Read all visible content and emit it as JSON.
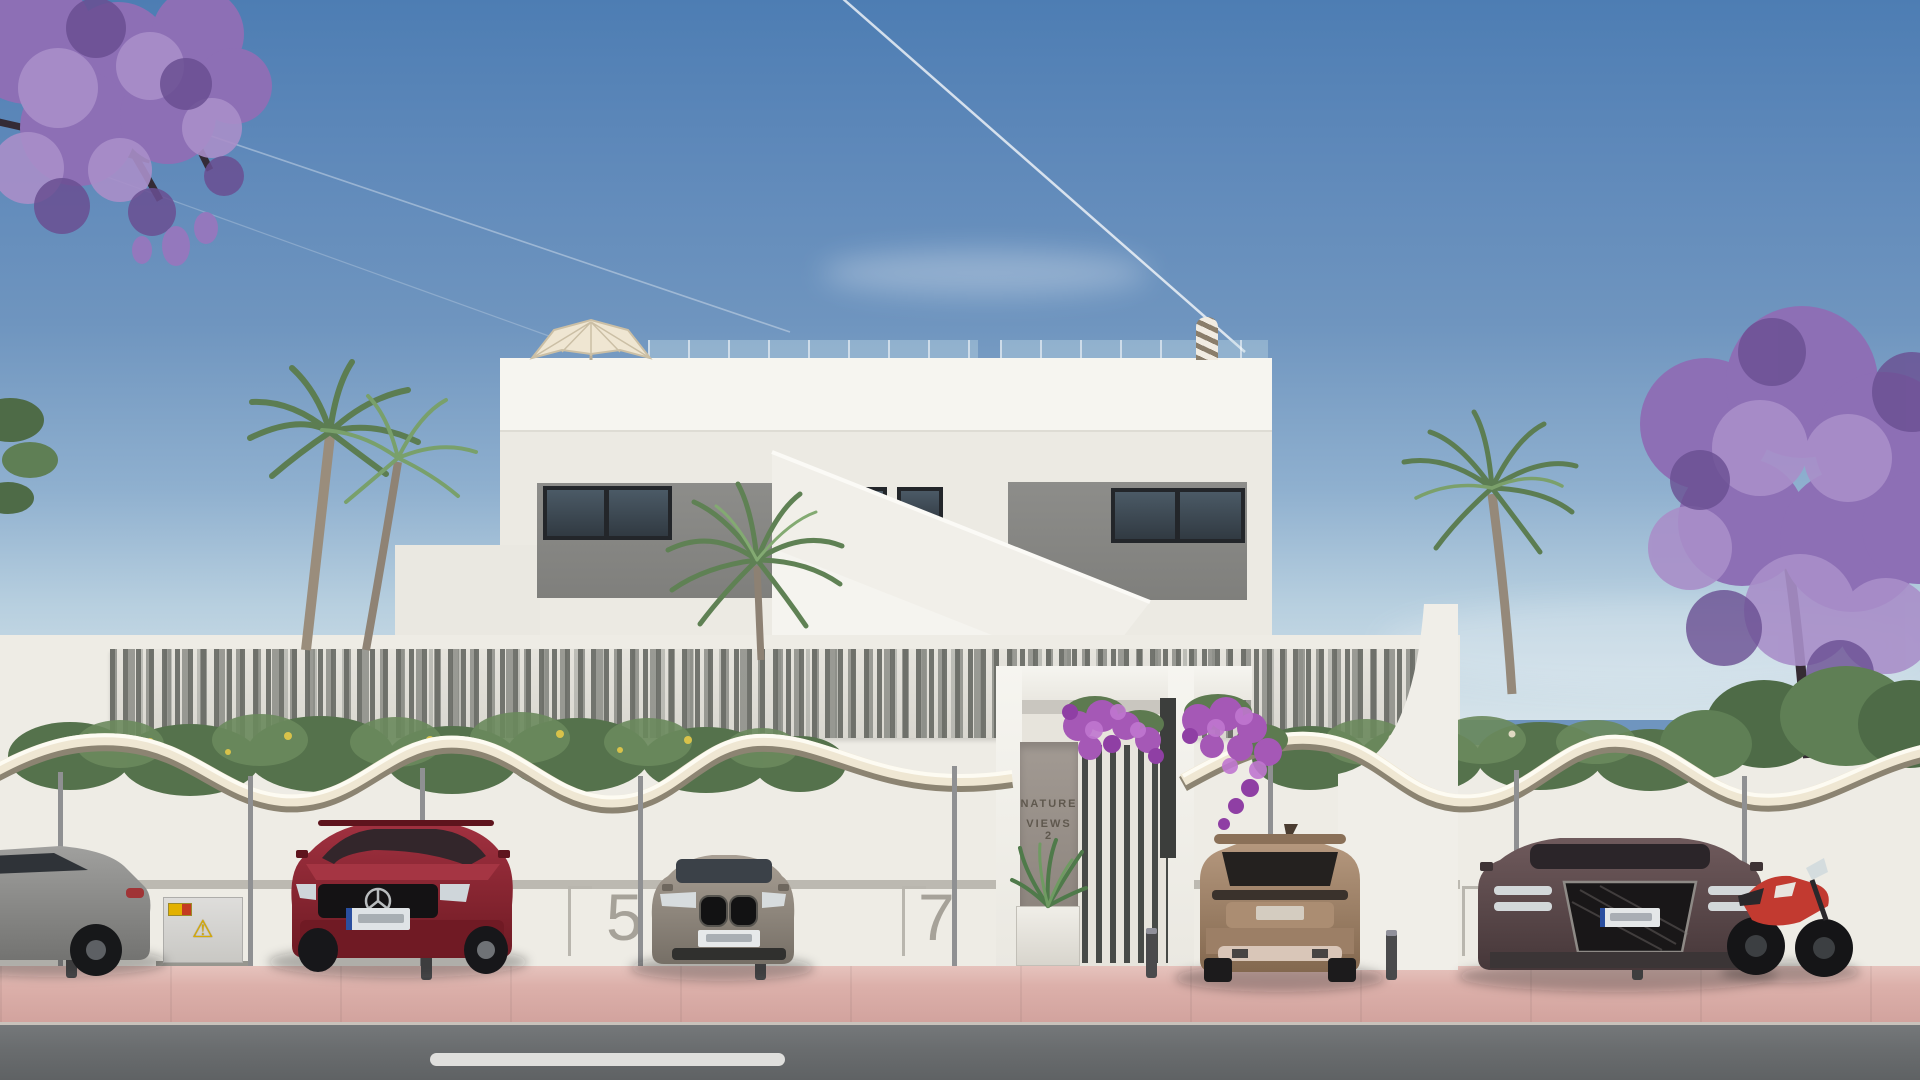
{
  "signage": {
    "project_line1": "NATURE",
    "project_line2": "VIEWS 2"
  },
  "parking": {
    "bays": [
      "2",
      "5",
      "7",
      "9"
    ]
  },
  "icons": {
    "warning_triangle": "⚠"
  },
  "palette": {
    "sky_top": "#4d7db3",
    "sky_horizon": "#d5e3ea",
    "building_white": "#f2f0ea",
    "panel_gray": "#8d8d8a",
    "window_dark": "#313a42",
    "fence_slat": "#6c6e68",
    "wall_white": "#eeece5",
    "bay_number_gray": "#a6a299",
    "canopy_cream": "#efe7d3",
    "sidewalk_pink": "#dcb0aa",
    "road_gray": "#6a6d6f",
    "center_line_white": "#e9e9e7",
    "jacaranda_purple": "#9478bd",
    "bougainvillea_purple": "#a558b6",
    "palm_green": "#5f8154",
    "hedge_green": "#55724c",
    "car_red": "#8a232e",
    "car_gray": "#99938b",
    "car_bronze": "#a4876e",
    "car_maroon": "#5f4d4e",
    "sedan_gray": "#909090",
    "motorcycle_red": "#c23a30",
    "sign_panel": "#998f89",
    "sign_text": "#5f584e",
    "warning_yellow": "#d9ab00"
  }
}
